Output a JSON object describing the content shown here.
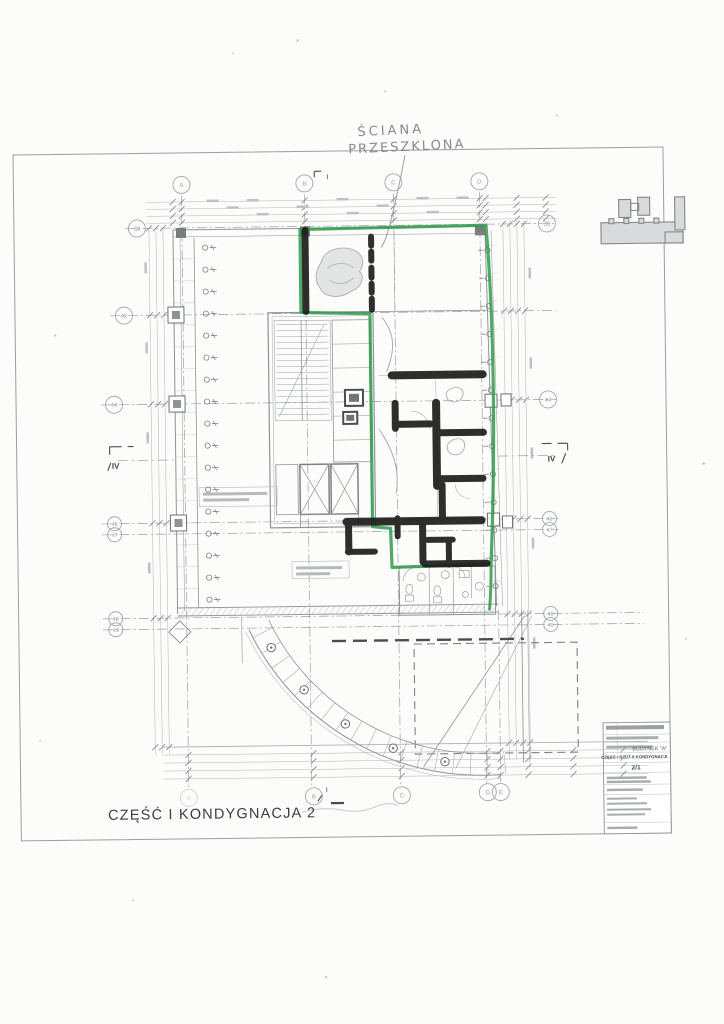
{
  "page": {
    "caption": "CZĘŚĆ I KONDYGNACJA 2"
  },
  "annotations": {
    "glazed_wall": {
      "line1": "ŚCIANA",
      "line2": "PRZESZKLONA"
    }
  },
  "title_block": {
    "building": "BUDYNEK \"A\"",
    "subtitle": "CZĘŚĆ I RZUT II KONDYGNACJI",
    "sheet_number": "2/1"
  },
  "grid": {
    "top_labels": [
      "A",
      "B",
      "C",
      "D"
    ],
    "bottom_labels": [
      "A",
      "B",
      "C",
      "D",
      "E"
    ],
    "left_labels": [
      "38",
      "42",
      "44",
      "46",
      "47",
      "48",
      "49"
    ],
    "right_labels": [
      "38",
      "44",
      "46",
      "47",
      "48",
      "49"
    ],
    "section_markers": {
      "top": "I",
      "bottom": "I",
      "left": "IV",
      "right": "IV"
    }
  },
  "colors": {
    "marker_green": "#2f9b4c",
    "marker_black": "#1d1d1b",
    "pencil": "#8b9094",
    "cad": "#9aa0a3",
    "paper": "#fcfcfb"
  }
}
